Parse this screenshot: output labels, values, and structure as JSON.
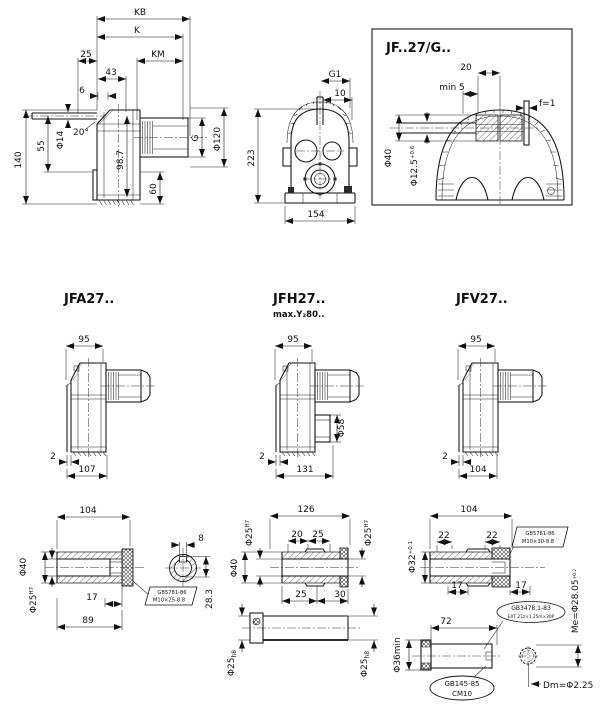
{
  "side": {
    "kb": "KB",
    "k": "K",
    "km": "KM",
    "d25": "25",
    "d43": "43",
    "d6": "6",
    "dia14": "Φ14",
    "angle": "20°",
    "d55": "55",
    "d140": "140",
    "d98_7": "98.7",
    "d60": "60",
    "g": "G",
    "dia120": "Φ120"
  },
  "front": {
    "g1": "G1",
    "d10": "10",
    "d223": "223",
    "d154": "154"
  },
  "detail": {
    "title": "JF..27/G..",
    "d20": "20",
    "min5": "min 5",
    "f1": "f=1",
    "dia40": "Φ40",
    "dia125": "Φ12.5",
    "dia125_tol": "+0.6"
  },
  "models": {
    "jfa": {
      "title": "JFA27..",
      "w": "95",
      "t": "2",
      "l": "107"
    },
    "jfh": {
      "title": "JFH27..",
      "subtitle": "max.Y₂80..",
      "w": "95",
      "t": "2",
      "l": "131",
      "boss": "Φ58"
    },
    "jfv": {
      "title": "JFV27..",
      "w": "95",
      "t": "2",
      "l": "104"
    }
  },
  "shafts": {
    "a": {
      "len": "104",
      "dia40": "Φ40",
      "bore": "Φ25",
      "bore_tol": "H7",
      "d17": "17",
      "d89": "89",
      "key_w": "8",
      "key_h": "28.3",
      "bolt_line1": "GB5781-86",
      "bolt_line2": "M10×25-8.8"
    },
    "h": {
      "len": "126",
      "bore_l": "Φ25",
      "bore_l_tol": "H7",
      "bore_r": "Φ25",
      "bore_r_tol": "H7",
      "d20": "20",
      "d25a": "25",
      "dia40": "Φ40",
      "d25b": "25",
      "d30": "30",
      "shaft_l": "Φ25",
      "shaft_l_tol": "h8",
      "shaft_r": "Φ25",
      "shaft_r_tol": "h8"
    },
    "v": {
      "len": "104",
      "d22a": "22",
      "d22b": "22",
      "dia32": "Φ32",
      "dia32_tol": "+0.1",
      "d17a": "17",
      "d17b": "17",
      "bolt_line1": "GB5781-86",
      "bolt_line2": "M10×30-8.8",
      "me": "Me=Φ28.05",
      "me_tol": "+0.2",
      "d72": "72",
      "dia36": "Φ36min",
      "spline_line1": "GB3478.1-83",
      "spline_line2": "EXT 21z×1.25m×30P",
      "center_line1": "GB145-85",
      "center_line2": "CM10",
      "dm": "Dm=Φ2.25"
    }
  }
}
